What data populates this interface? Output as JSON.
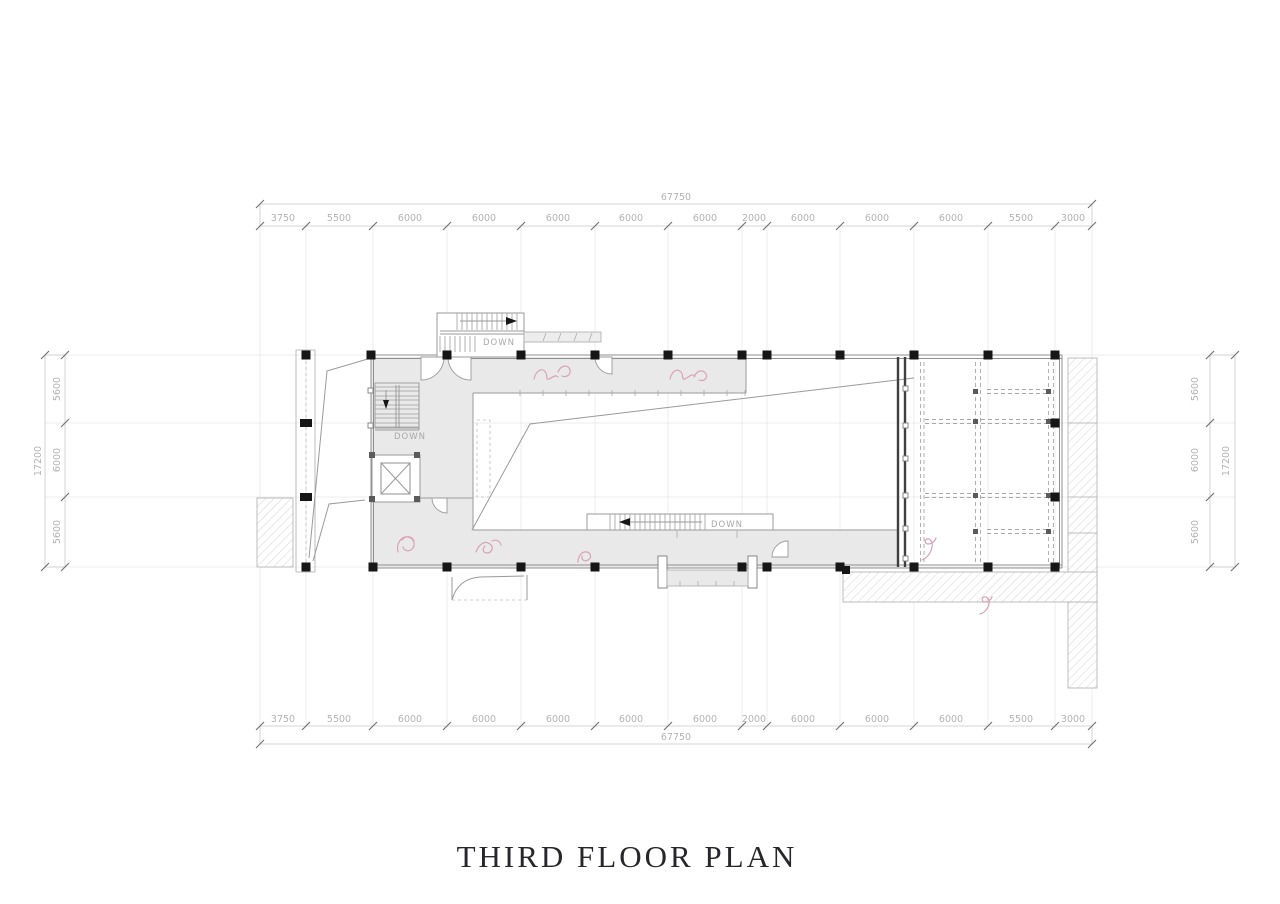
{
  "title": "THIRD FLOOR PLAN",
  "labels": {
    "down_top_stair": "DOWN",
    "down_left_stair": "DOWN",
    "down_bottom_stair": "DOWN"
  },
  "dimensions": {
    "top": {
      "total": "67750",
      "segments": [
        "3750",
        "5500",
        "6000",
        "6000",
        "6000",
        "6000",
        "6000",
        "2000",
        "6000",
        "6000",
        "6000",
        "5500",
        "3000"
      ]
    },
    "bottom": {
      "total": "67750",
      "segments": [
        "3750",
        "5500",
        "6000",
        "6000",
        "6000",
        "6000",
        "6000",
        "2000",
        "6000",
        "6000",
        "6000",
        "5500",
        "3000"
      ]
    },
    "left": {
      "total": "17200",
      "segments": [
        "5600",
        "6000",
        "5600"
      ]
    },
    "right": {
      "total": "17200",
      "segments": [
        "5600",
        "6000",
        "5600"
      ]
    }
  },
  "colors": {
    "slab_gray": "#e9e9e9",
    "wall_gray": "#8f8f8f",
    "column_black": "#161616",
    "dimension_text": "#b3b3b3",
    "entourage_pink": "#d9a3b1",
    "title_text": "#26262b",
    "hatch_line": "#d4d4d4"
  }
}
